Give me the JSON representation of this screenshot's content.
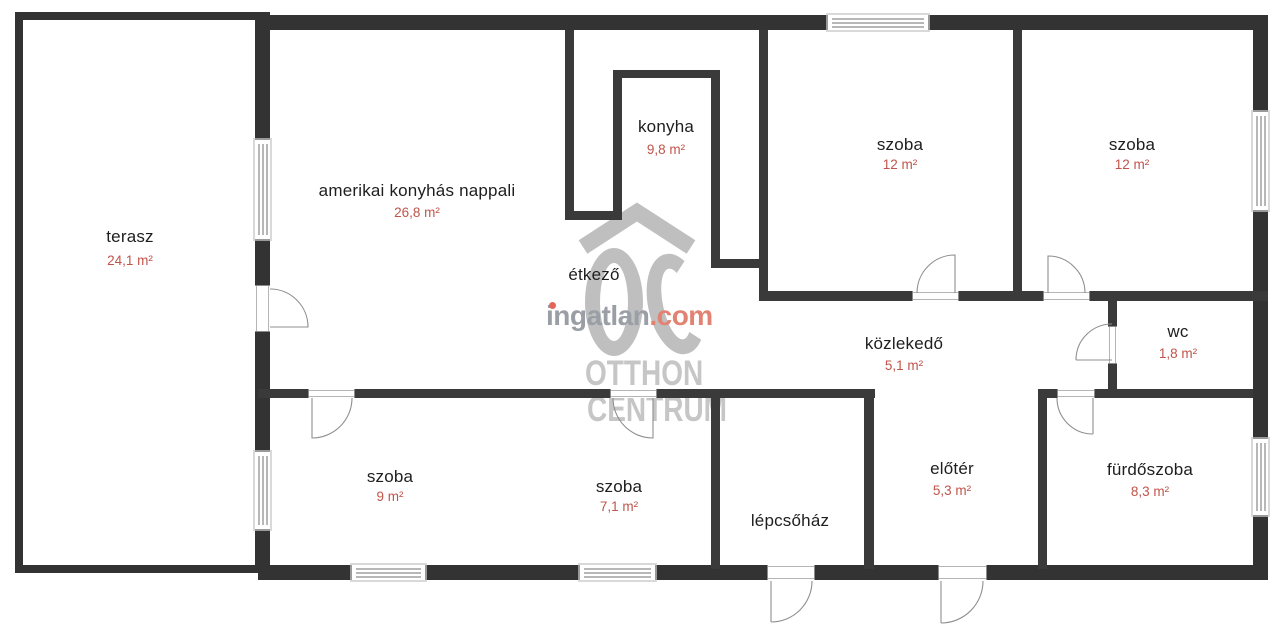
{
  "floorplan": {
    "rooms": [
      {
        "name": "terasz",
        "area": "24,1 m²"
      },
      {
        "name": "amerikai konyhás nappali",
        "area": "26,8 m²"
      },
      {
        "name": "konyha",
        "area": "9,8 m²"
      },
      {
        "name": "étkező",
        "area": ""
      },
      {
        "name": "szoba",
        "area": "12 m²"
      },
      {
        "name": "szoba",
        "area": "12 m²"
      },
      {
        "name": "közlekedő",
        "area": "5,1 m²"
      },
      {
        "name": "wc",
        "area": "1,8 m²"
      },
      {
        "name": "szoba",
        "area": "9 m²"
      },
      {
        "name": "szoba",
        "area": "7,1 m²"
      },
      {
        "name": "lépcsőház",
        "area": ""
      },
      {
        "name": "előtér",
        "area": "5,3 m²"
      },
      {
        "name": "fürdőszoba",
        "area": "8,3 m²"
      }
    ],
    "watermark": {
      "logo": "OC",
      "brand": "ingatlan",
      "brand_tld": ".com",
      "line1": "OTTHON",
      "line2": "CENTRUM"
    },
    "colors": {
      "wall": "#333333",
      "room_text": "#1e1e1e",
      "area_text": "#c0544b",
      "watermark_gray": "#bfbfbf",
      "watermark_accent": "#e28272"
    }
  }
}
